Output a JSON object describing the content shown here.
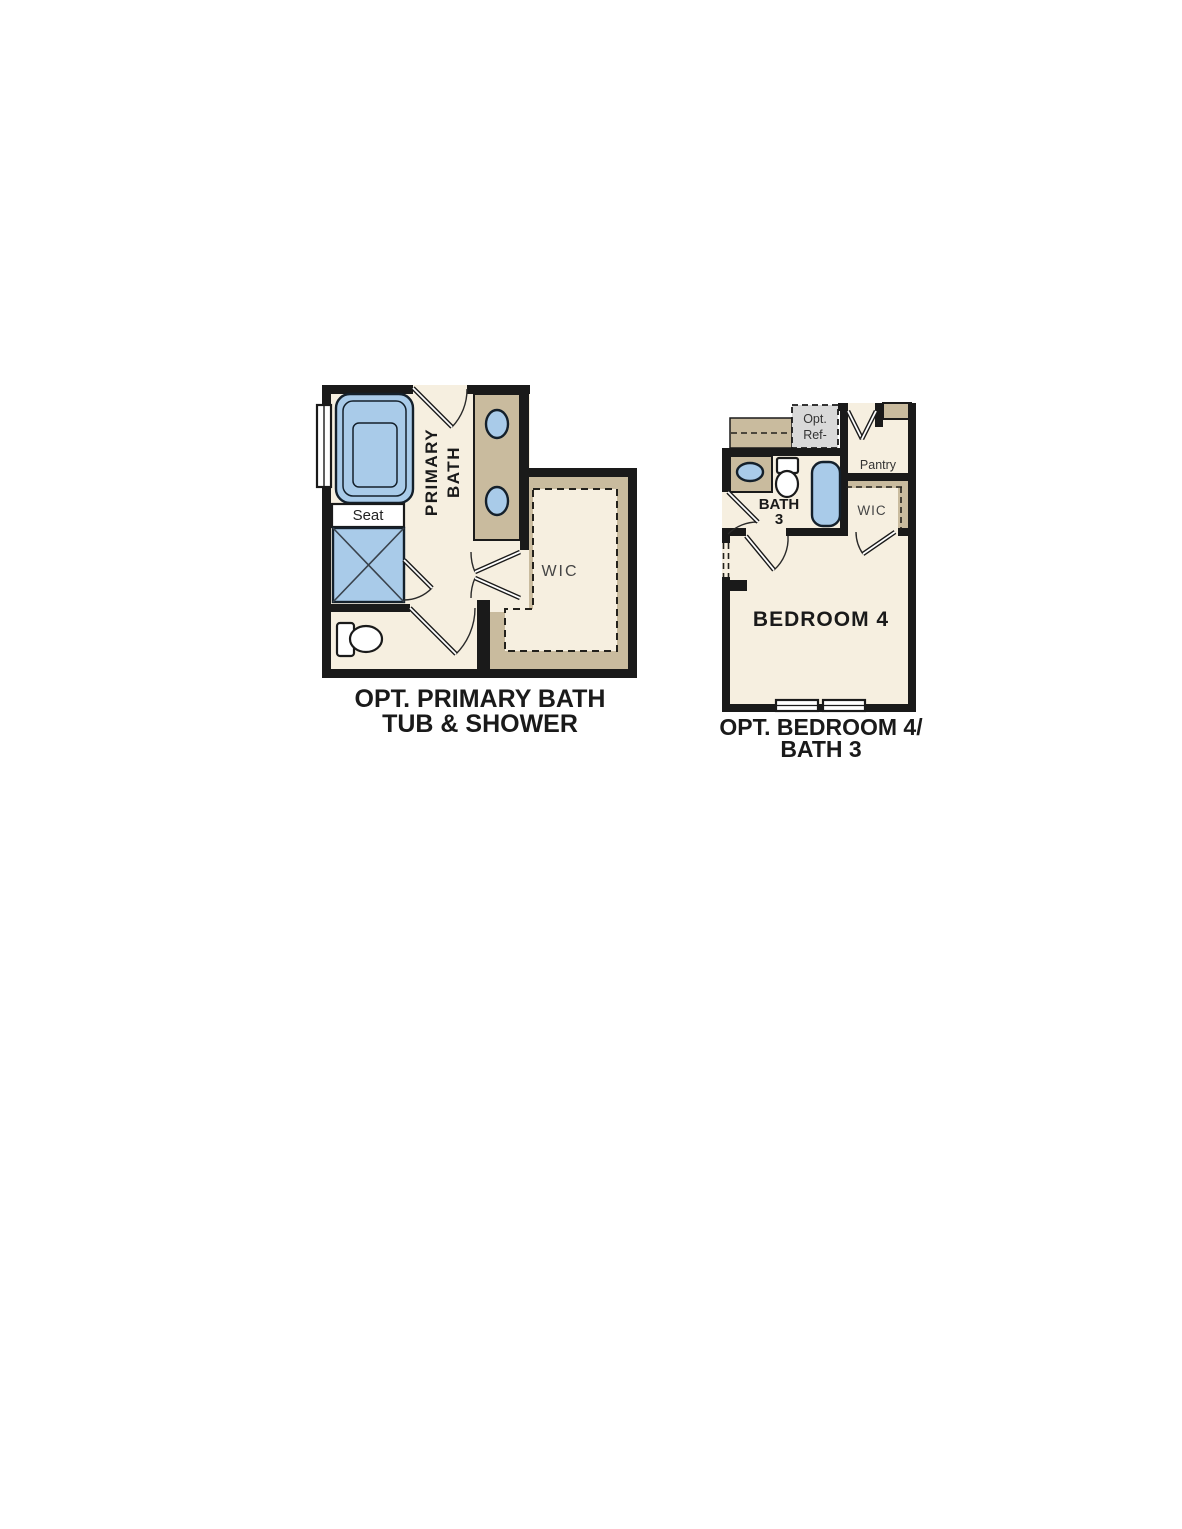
{
  "page": {
    "background": "#ffffff"
  },
  "colors": {
    "wall": "#1a1a1a",
    "floor_cream": "#f6efe0",
    "cabinet_tan": "#c9bb9e",
    "fixture_blue": "#a9cbe9",
    "ref_box_gray": "#d9d9d9",
    "label_text": "#1a1a1a"
  },
  "plans": {
    "primary_bath": {
      "title_line1": "OPT. PRIMARY BATH",
      "title_line2": "TUB & SHOWER",
      "labels": {
        "room_line1": "PRIMARY",
        "room_line2": "BATH",
        "seat": "Seat",
        "wic": "WIC"
      }
    },
    "bedroom4": {
      "title_line1": "OPT. BEDROOM 4/",
      "title_line2": "BATH 3",
      "labels": {
        "opt_ref_line1": "Opt.",
        "opt_ref_line2": "Ref-",
        "pantry": "Pantry",
        "bath_line1": "BATH",
        "bath_line2": "3",
        "wic": "WIC",
        "bedroom": "BEDROOM 4"
      }
    }
  }
}
